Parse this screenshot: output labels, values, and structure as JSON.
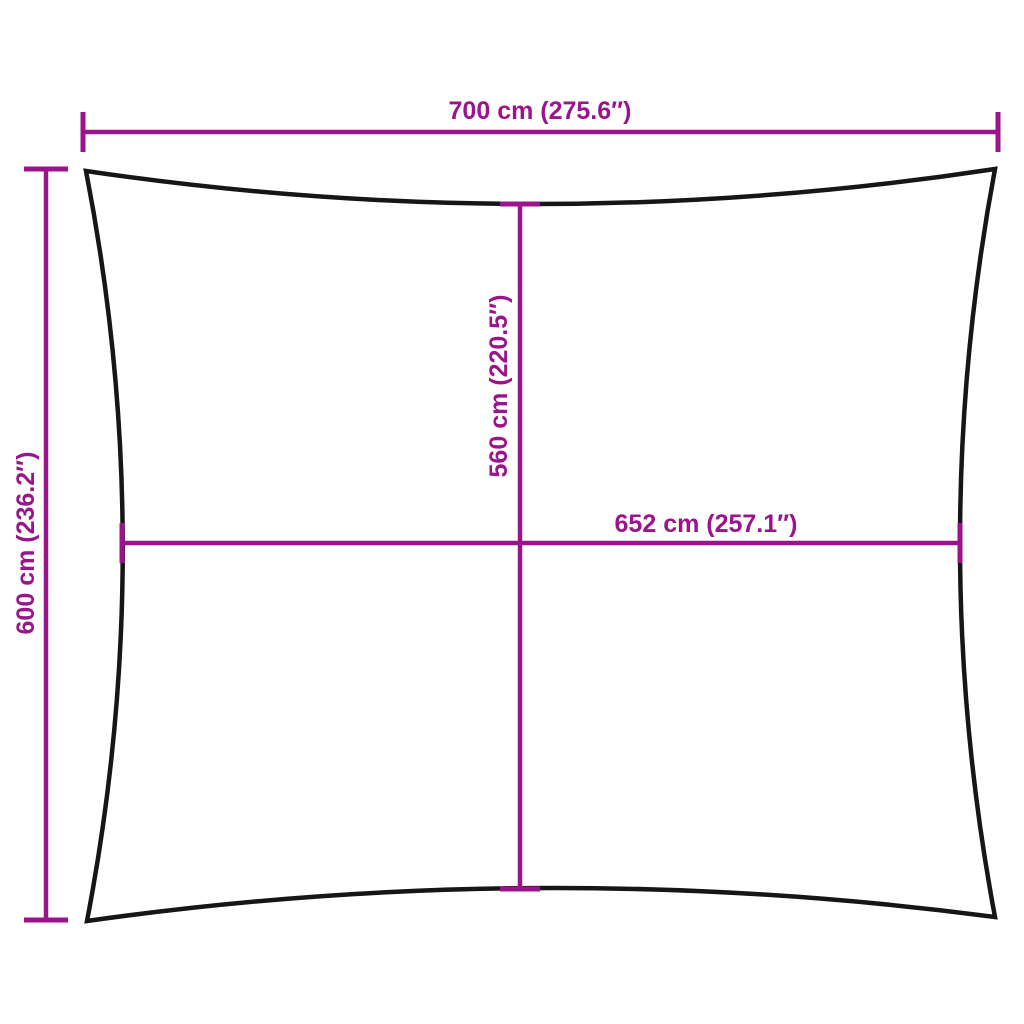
{
  "image": {
    "background": "#ffffff",
    "accent_color": "#9a148c",
    "outline_color": "#161616",
    "kind": "shade-sail product dimension drawing"
  },
  "diagram": {
    "shape": "rectangle with concave edges (sun shade sail outline)",
    "dimensions": {
      "top_width": {
        "label": "700 cm (275.6″)",
        "cm": 700,
        "inches": 275.6
      },
      "side_height": {
        "label": "600 cm (236.2″)",
        "cm": 600,
        "inches": 236.2
      },
      "center_height": {
        "label": "560 cm (220.5″)",
        "cm": 560,
        "inches": 220.5
      },
      "center_width": {
        "label": "652 cm (257.1″)",
        "cm": 652,
        "inches": 257.1
      }
    }
  }
}
